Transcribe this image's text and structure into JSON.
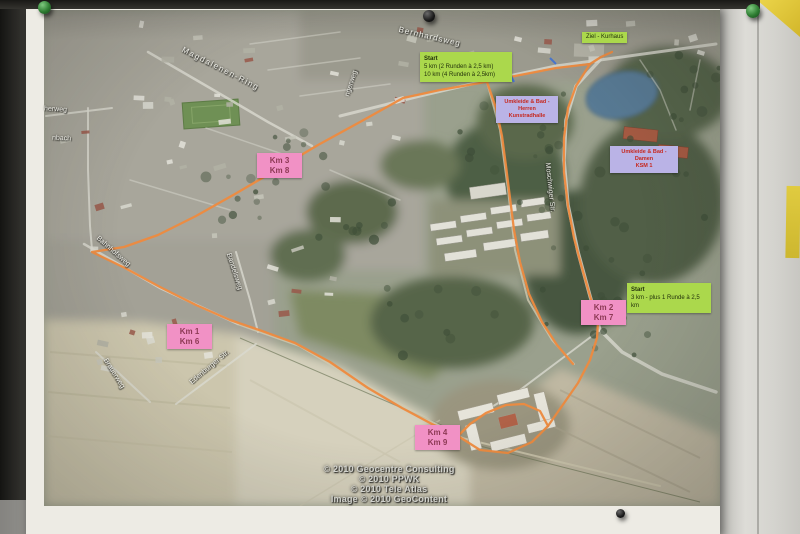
{
  "colors": {
    "route_orange": "#ee8a3e",
    "km_label_bg": "#f191c5",
    "km_label_text": "#8d3a55",
    "start_label_bg": "#abd84c",
    "start_label_text": "#23320c",
    "facility_label_bg": "#bab3e6",
    "facility_label_text": "#c6281f",
    "street_label_text": "#f4f4ee",
    "copyright_text": "#d2d3cf"
  },
  "map": {
    "start_finish_labels": {
      "start_main": {
        "line1": "Start",
        "line2": "5 km (2 Runden à 2,5 km)",
        "line3": "10 km (4 Runden à 2,5km)"
      },
      "ziel": "Ziel - Kurhaus",
      "start_3km": {
        "line1": "Start",
        "line2": "3 km - plus 1 Runde à 2,5 km"
      }
    },
    "facility_labels": {
      "herren": {
        "line1": "Umkleide & Bad - Herren",
        "line2": "Kunstradhalle"
      },
      "damen": {
        "line1": "Umkleide & Bad - Damen",
        "line2": "KSM 1"
      }
    },
    "km_markers": {
      "m38": {
        "line1": "Km 3",
        "line2": "Km 8"
      },
      "m16": {
        "line1": "Km 1",
        "line2": "Km 6"
      },
      "m27": {
        "line1": "Km 2",
        "line2": "Km 7"
      },
      "m49": {
        "line1": "Km 4",
        "line2": "Km 9"
      }
    },
    "street_labels": [
      "Bernhardsweg",
      "Magdalenen-Ring",
      "Moschwiger Str.",
      "Bahnhofsweg",
      "Bandelsweg",
      "Brauerweg",
      "Edenburger Str.",
      "herweg",
      "nbach",
      "ngerweg"
    ],
    "copyright": {
      "line1": "© 2010 Geocentre Consulting",
      "line2": "© 2010 PPWK",
      "line3": "© 2010 Tele Atlas",
      "line4": "Image © 2010 GeoContent"
    }
  }
}
